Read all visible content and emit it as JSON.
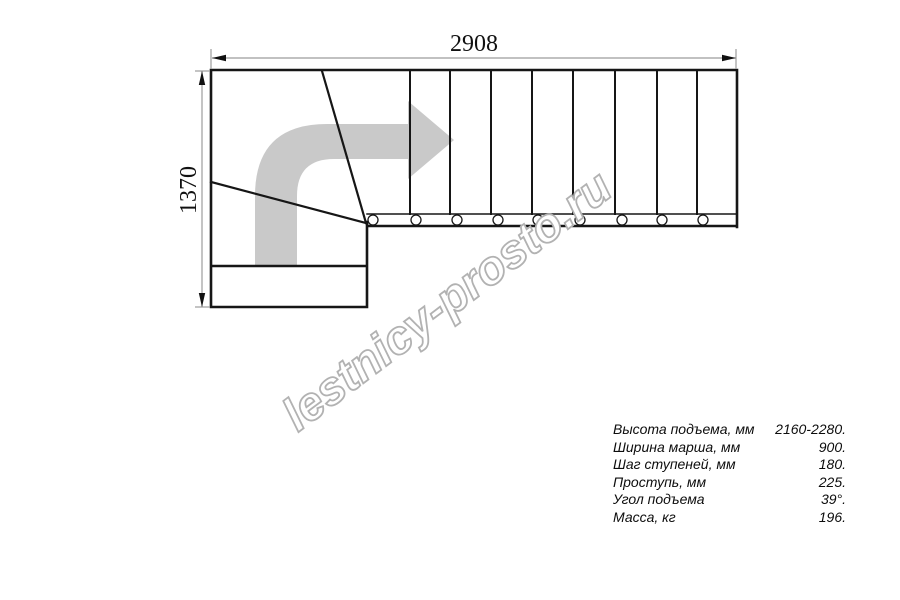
{
  "drawing": {
    "width_dimension": "2908",
    "height_dimension": "1370"
  },
  "watermark": {
    "text": "lestnicy-prosto.ru"
  },
  "specs": {
    "rows": [
      {
        "label": "Высота подъема, мм",
        "value": "2160-2280."
      },
      {
        "label": "Ширина марша, мм",
        "value": "900."
      },
      {
        "label": "Шаг ступеней, мм",
        "value": "180."
      },
      {
        "label": "Проступь, мм",
        "value": "225."
      },
      {
        "label": "Угол подъема",
        "value": "39°."
      },
      {
        "label": "Масса, кг",
        "value": "196."
      }
    ]
  },
  "colors": {
    "line": "#161616",
    "dimension": "#9c9c9c",
    "arrow": "#c9c9c9",
    "watermark_outline": "#b2b2b2",
    "text": "#111111"
  }
}
